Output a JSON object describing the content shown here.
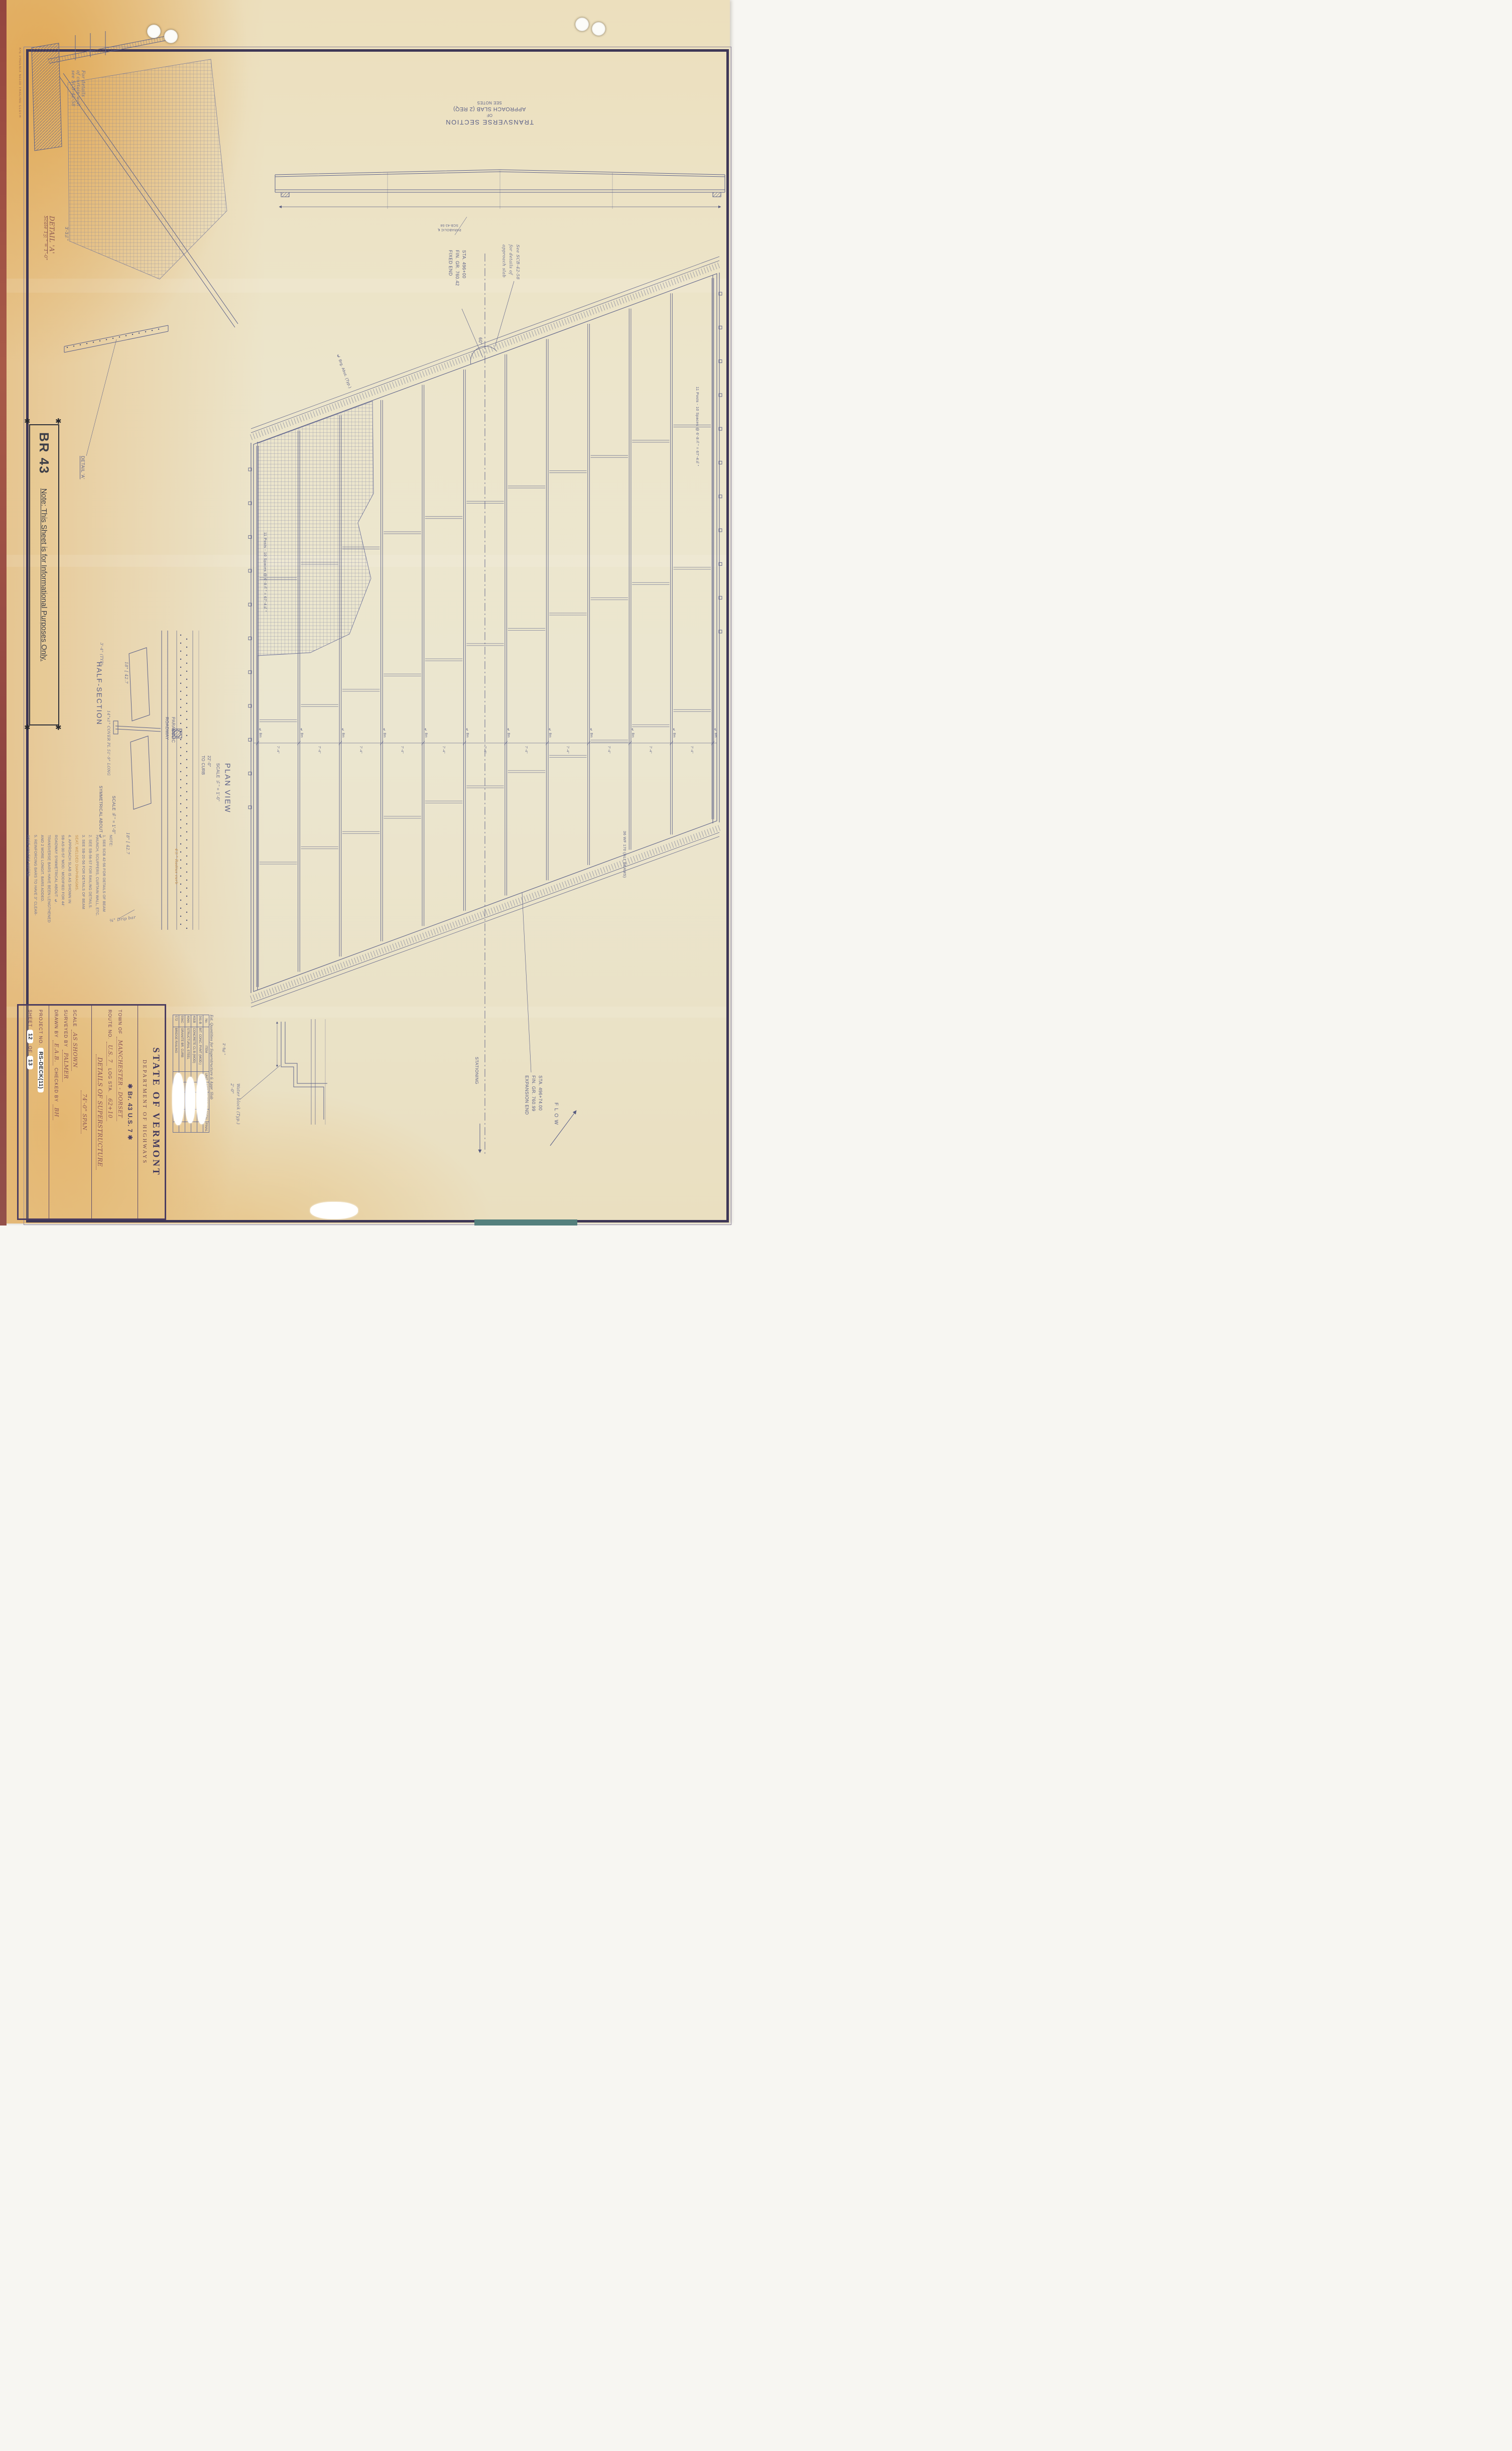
{
  "stamps": {
    "ke_brand": "K•E  PHOENIX No100  TRACING CLOTH",
    "blm": "B.L.M. INC."
  },
  "corner_note": {
    "lines": [
      "For details",
      "of curtain wall",
      "see SCB-42-58"
    ]
  },
  "detail_a": {
    "title": "DETAIL 'A'",
    "scale": "Scale 1½\" = 1'-0\"",
    "dim": "3'-3¼\"",
    "callout": "DETAIL 'A'"
  },
  "br43_box": {
    "title": "BR 43",
    "note": "Note: This Sheet is for Informational Purposes Only."
  },
  "transverse_section": {
    "caption_lines": [
      "TRANSVERSE SECTION",
      "OF",
      "APPROACH SLAB (2 REQ)",
      "SEE NOTES"
    ],
    "sub_labels": [
      "PARABOLIC ℄",
      "SCB-42-58"
    ]
  },
  "plan_view": {
    "title_lines": [
      "PLAN VIEW",
      "SCALE ¼\" = 1'-0\""
    ],
    "fixed_end": [
      "STA. 496+00",
      "FIN. GR. 760.42",
      "FIXED END"
    ],
    "expansion_end": [
      "STA. 496+74.00",
      "FIN. GR. 760.99",
      "EXPANSION END"
    ],
    "approach_note": [
      "See SCB-42-58",
      "for details of",
      "approach slab"
    ],
    "skew_angle": "60°",
    "abut_label": "℄ Brg. Abut. (Typ.)",
    "stationing": "STATIONING",
    "flow": "FLOW",
    "posts_left": "11 Posts - 10 Spaces @ 6'-8⅞\" = 67'-4¾\"",
    "posts_right": "11 Posts - 10 Spaces @ 6'-8⅞\" = 67'-4¾\"",
    "beam_size": "36 WF 170 (ALL BEAMS)",
    "bay_dim": "7'-4\"",
    "beam_cl": "℄ Bm",
    "curb_dim": [
      "22'-0\"",
      "TO CURB"
    ],
    "water_block": [
      "Water block (Typ.)",
      "2'-0\""
    ],
    "dim_2_5": "2'-5¾\""
  },
  "half_section": {
    "title": "HALF-SECTION",
    "subtitle": "SYMMETRICAL ABOUT ℄",
    "scale": "SCALE ⅜\" = 1'-0\"",
    "channel_top": "18\" [ 42.7",
    "channel_bottom": "18\" [ 42.7",
    "cover_plate": "14\"x1\" COVER PL 51'-9\" LONG",
    "typ_dim": "3'-4\" (TYP)",
    "parabolic_lines": [
      "PARABOLIC",
      "ROADWAY"
    ],
    "radius_curb": "4½\" Radius curb",
    "drip_bar": "¾\" Drip bar"
  },
  "notes": {
    "orange_index": 5,
    "lines": [
      "NOTE:",
      "1. SEE SCB 42-56 FOR DETAILS OF BEAM",
      "    HAUNCH, SCUPPERS, CURTAIN WALL, ETC.",
      "2. SEE SB-56-57 FOR RAILING DETAILS.",
      "3. SEE SB-20-56 FOR DETAILS OF BEAM",
      "    SEAT, WELDED DIAPHRAGMS.",
      "4. APPROACH SLAB IS AS SHOWN IN",
      "    SB-AS-30-57 'MOD.' MODIFIED FOR 44'",
      "    ROADWAY SYMMETRICAL ABOUT ℄.",
      "    TRANSVERSE BARS HAVE BEEN LENGTHENED",
      "    AND 2 MORE LONGIT. BARS ADDED.",
      "5. REINFORCING BARS TO HAVE 3\" CLEAR-",
      "    ANCE UNLESS NOTED."
    ]
  },
  "quantities": {
    "title": "Est. Quantities for Superstructure & Appr. Slab",
    "headers": [
      "No.",
      "ITEM",
      "UNIT",
      "NET",
      "OVERRUN",
      "TOTAL",
      "FINAL"
    ],
    "rows": [
      [
        "361-B",
        "BIT. CONC. PVMT (MOD.)"
      ],
      [
        "401B",
        "CONCRETE CL B (MOD)"
      ],
      [
        "404A",
        "STRUCTURAL STEEL"
      ],
      [
        "556C",
        "GRANITE BR. CURB"
      ],
      [
        "572",
        "BRIDGE RAILING"
      ]
    ]
  },
  "title_block": {
    "agency": "STATE OF VERMONT",
    "department": "DEPARTMENT OF HIGHWAYS",
    "bridge_line": "✱  Br. 43    U.S. 7  ✱",
    "town_label": "TOWN OF",
    "town_value": "MANCHESTER - DORSET",
    "route_label": "ROUTE NO.",
    "route_value": "U.S. 7",
    "log_label": "LOG STA.",
    "log_value": "62+10",
    "details_line": "DETAILS OF SUPERSTRUCTURE",
    "span_line": "74'-0\" SPAN",
    "scale_label": "SCALE",
    "scale_value": "AS SHOWN",
    "surveyed_label": "SURVEYED BY",
    "surveyed_value": "PALMER",
    "drawn_label": "DRAWN BY",
    "drawn_value": "E.A.B.",
    "checked_label": "CHECKED BY",
    "checked_value": "BH",
    "project_label": "PROJECT NO.",
    "project_value": "RS-DECK(11)",
    "sheet_label": "SHEET",
    "sheet_no": "12",
    "of_label": "OF",
    "sheet_total": "13"
  }
}
